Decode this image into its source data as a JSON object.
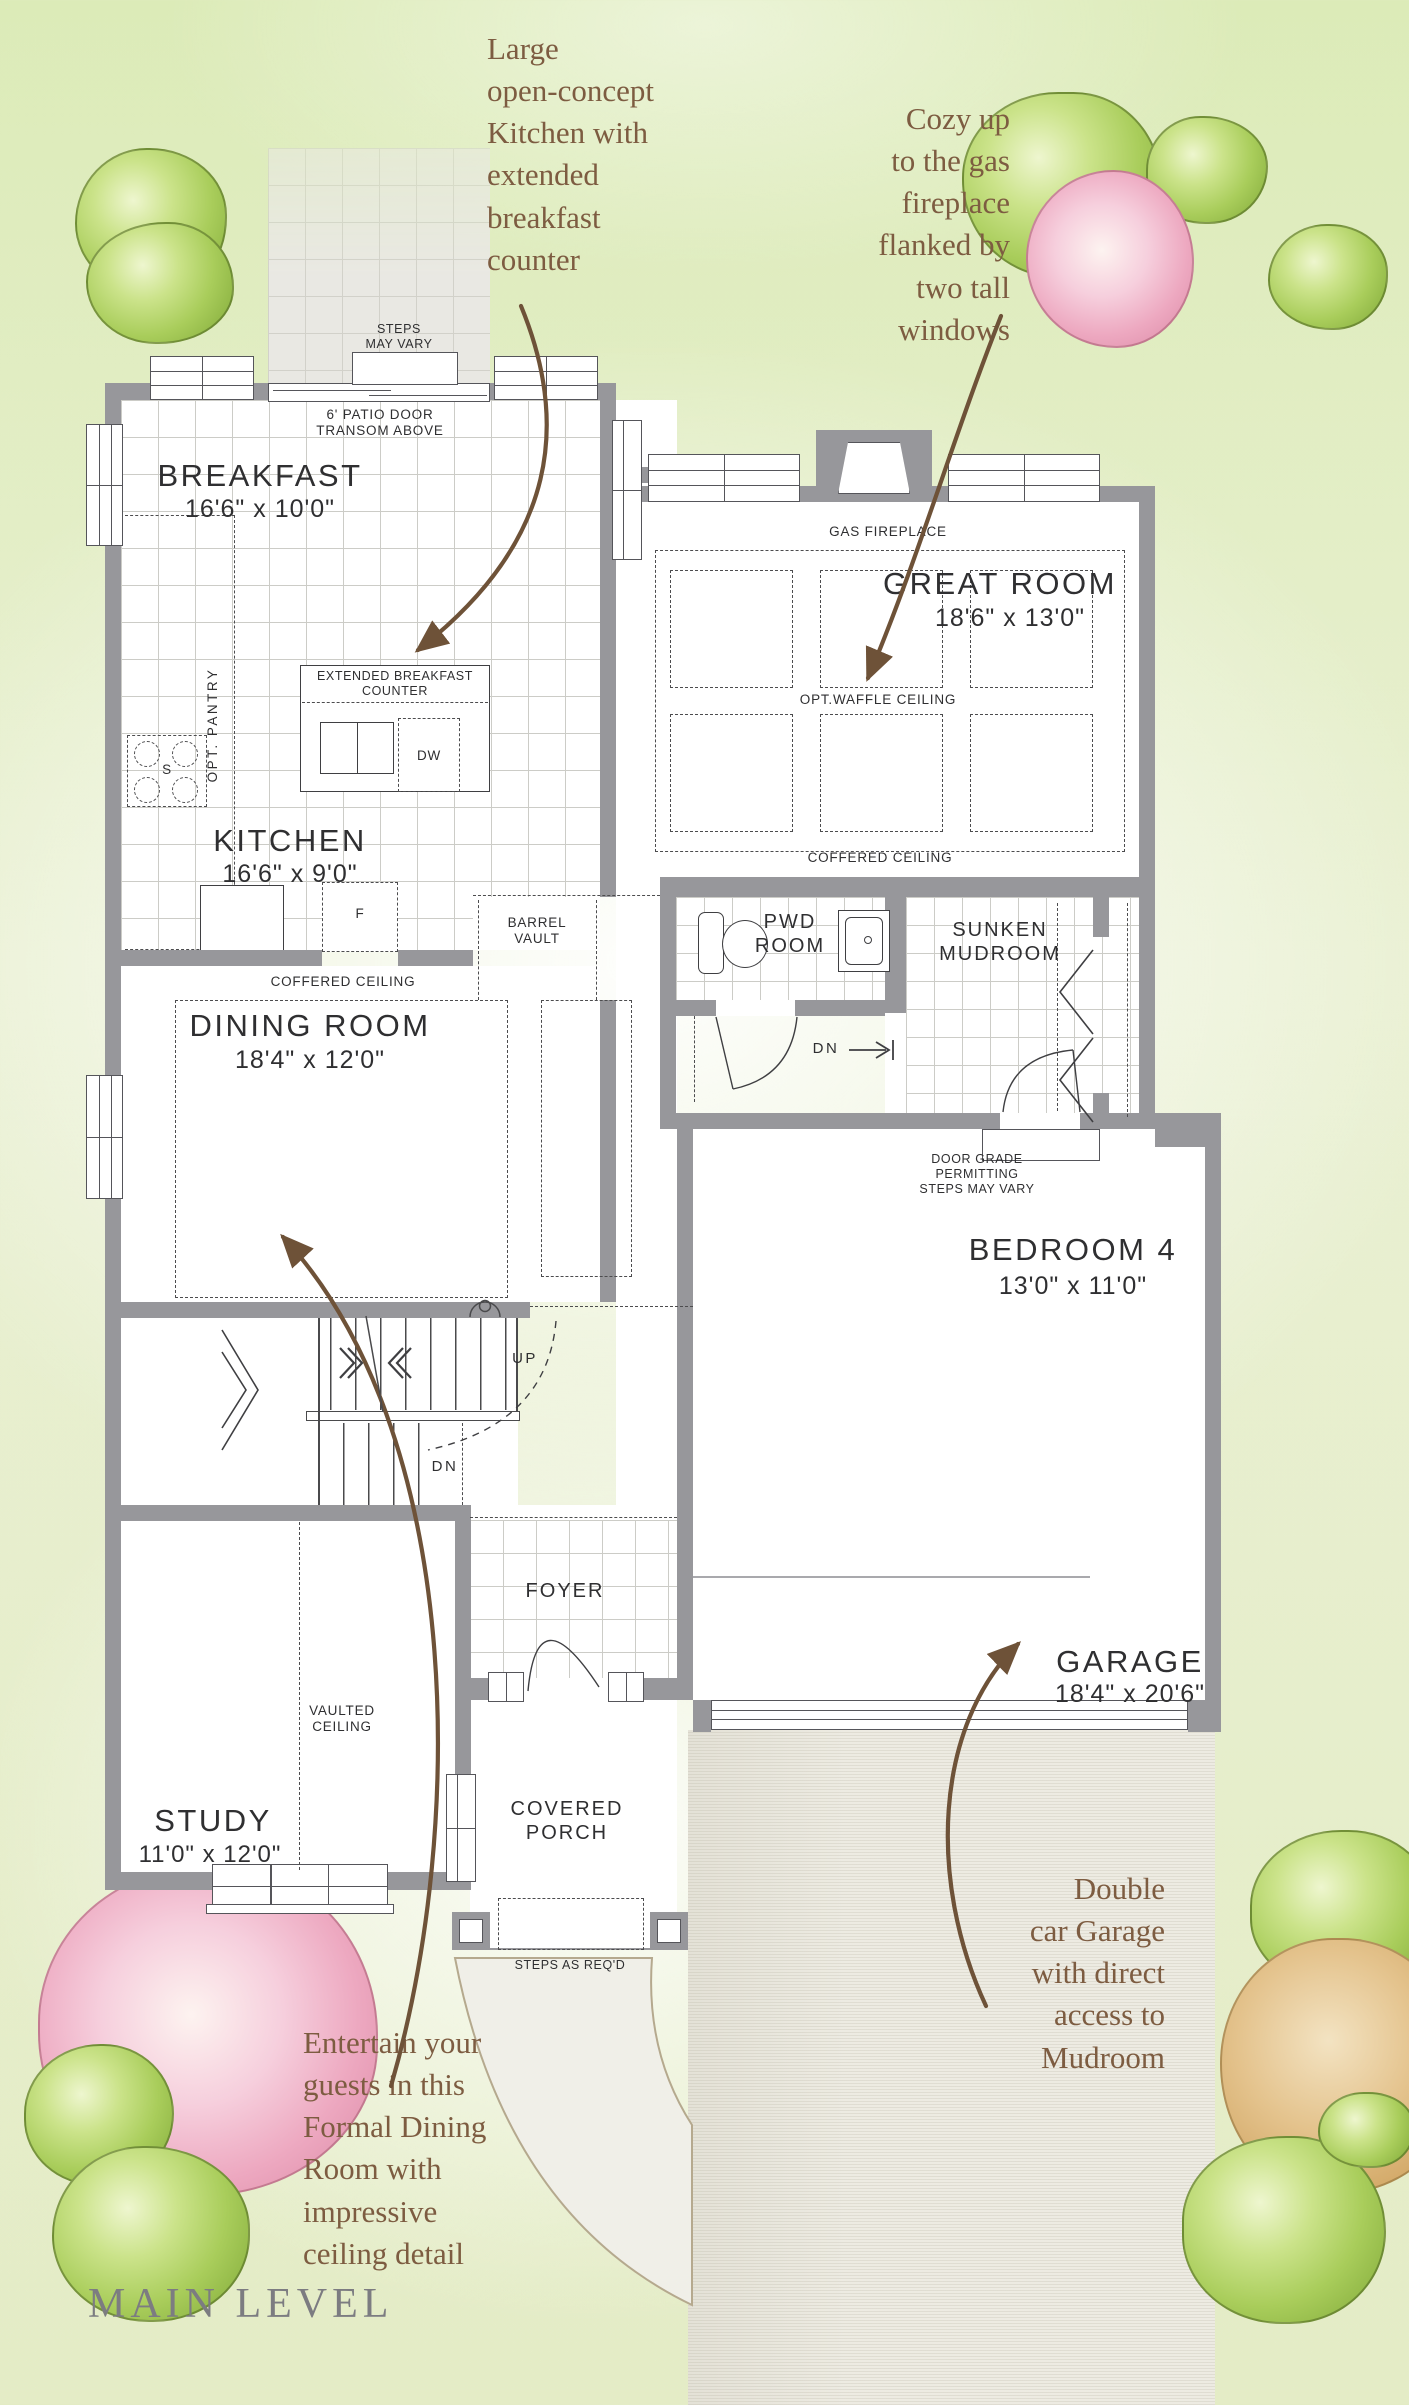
{
  "page": {
    "title": "MAIN LEVEL"
  },
  "annotations": {
    "kitchen": "Large\nopen-concept\nKitchen with\nextended\nbreakfast\ncounter",
    "fireplace": "Cozy up\nto the gas\nfireplace\nflanked by\ntwo tall\nwindows",
    "dining": "Entertain your\nguests in this\nFormal Dining\nRoom with\nimpressive\nceiling detail",
    "garage": "Double\ncar Garage\nwith direct\naccess to\nMudroom"
  },
  "rooms": {
    "breakfast": {
      "name": "BREAKFAST",
      "dims": "16'6\" x 10'0\""
    },
    "kitchen": {
      "name": "KITCHEN",
      "dims": "16'6\" x 9'0\""
    },
    "great_room": {
      "name": "GREAT ROOM",
      "dims": "18'6\" x 13'0\""
    },
    "dining_room": {
      "name": "DINING ROOM",
      "dims": "18'4\" x 12'0\""
    },
    "bedroom4": {
      "name": "BEDROOM 4",
      "dims": "13'0\" x 11'0\""
    },
    "garage": {
      "name": "GARAGE",
      "dims": "18'4\" x 20'6\""
    },
    "study": {
      "name": "STUDY",
      "dims": "11'0\" x 12'0\""
    },
    "pwd": {
      "name": "PWD\nROOM"
    },
    "mudroom": {
      "name": "SUNKEN\nMUDROOM"
    },
    "foyer": {
      "name": "FOYER"
    },
    "porch": {
      "name": "COVERED\nPORCH"
    }
  },
  "labels": {
    "steps_may_vary": "STEPS\nMAY VARY",
    "patio_door": "6' PATIO DOOR\nTRANSOM ABOVE",
    "gas_fireplace": "GAS FIREPLACE",
    "waffle": "OPT.WAFFLE CEILING",
    "coffered_great": "COFFERED CEILING",
    "coffered_dining": "COFFERED CEILING",
    "pantry": "OPT. PANTRY",
    "counter": "EXTENDED BREAKFAST\nCOUNTER",
    "dw": "DW",
    "fridge": "F",
    "stove": "S",
    "barrel": "BARREL\nVAULT",
    "up": "UP",
    "dn_stairs": "DN",
    "dn_mud": "DN",
    "door_grade": "DOOR GRADE\nPERMITTING\nSTEPS MAY VARY",
    "vaulted": "VAULTED\nCEILING",
    "steps_reqd": "STEPS AS REQ'D"
  },
  "colors": {
    "wall": "#97979b",
    "line": "#3f3f42",
    "annotation_text": "#7d5c41",
    "title_text": "#7c7c81",
    "background_green": "#e6edca",
    "driveway": "#edebe2"
  }
}
